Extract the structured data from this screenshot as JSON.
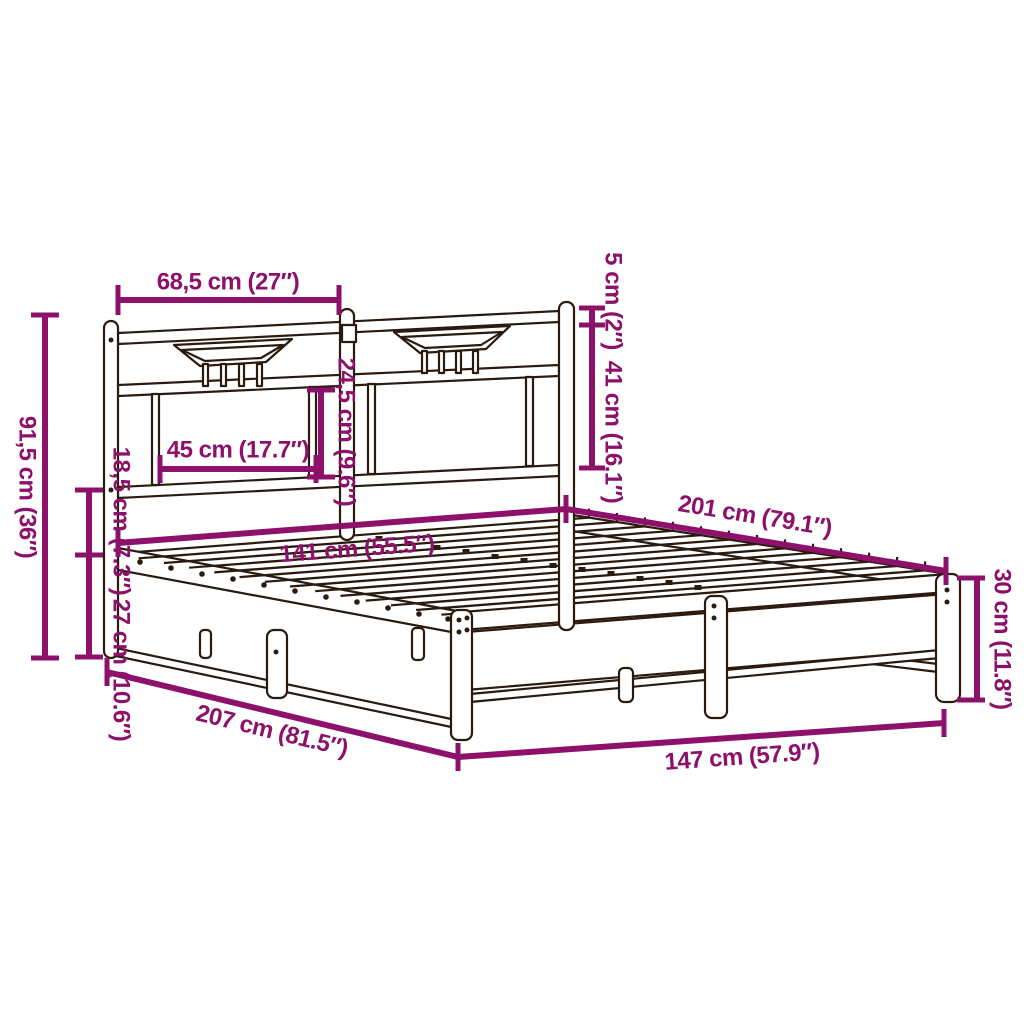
{
  "meta": {
    "diagram_type": "bed-frame dimension diagram",
    "background_color": "#ffffff",
    "dimension_color": "#8D106A",
    "frame_line_color": "#2B1A0E"
  },
  "dims": {
    "headboard_section_width": "68,5 cm (27″)",
    "post_cap_height": "5 cm (2″)",
    "headboard_upper_height": "41 cm (16.1″)",
    "headboard_panel_height": "24,5 cm (9.6″)",
    "headboard_panel_width": "45 cm (17.7″)",
    "total_height": "91,5 cm (36″)",
    "headboard_lower_gap": "18,5 cm (7.3″)",
    "platform_height": "27 cm (10.6″)",
    "inner_width": "141 cm (55.5″)",
    "inner_length": "201 cm (79.1″)",
    "outer_length": "207 cm (81.5″)",
    "outer_width": "147 cm (57.9″)",
    "foot_frame_height": "30 cm (11.8″)"
  }
}
